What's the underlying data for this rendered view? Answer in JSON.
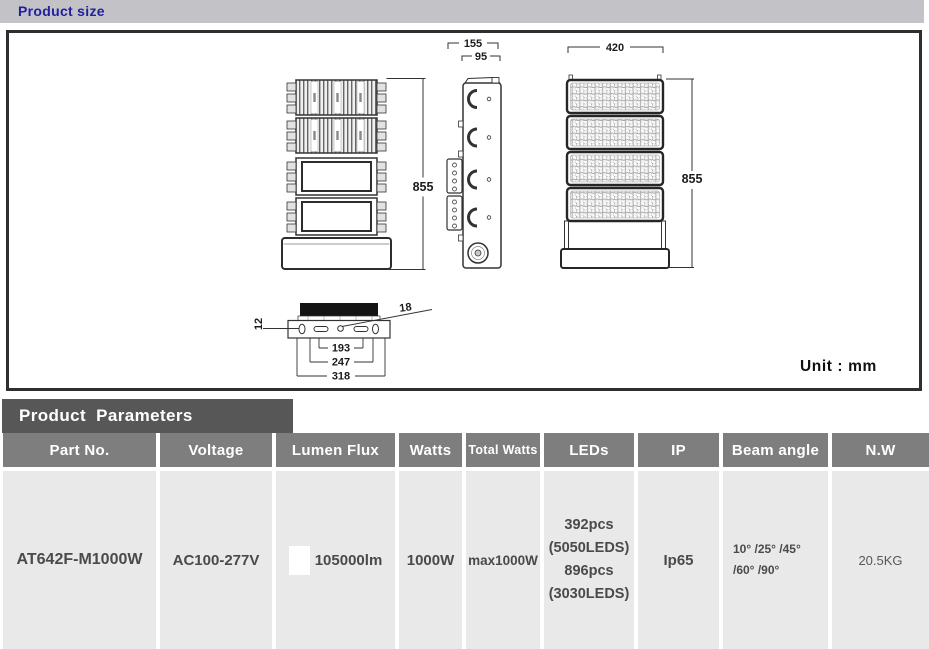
{
  "page": {
    "size_section_title": "Product size",
    "unit_label": "Unit : mm"
  },
  "drawing": {
    "dims": {
      "side_depth": "155",
      "side_body": "95",
      "front_width": "420",
      "back_height": "855",
      "front_height": "855",
      "mount_thickness": "12",
      "mount_hole": "18",
      "mount_slot_span": "193",
      "mount_hole_span": "247",
      "mount_width": "318"
    }
  },
  "parameters": {
    "section_title": "Product  Parameters",
    "columns": [
      "Part No.",
      "Voltage",
      "Lumen Flux",
      "Watts",
      "Total Watts",
      "LEDs",
      "IP",
      "Beam angle",
      "N.W"
    ],
    "row": {
      "part_no": "AT642F-M1000W",
      "voltage": "AC100-277V",
      "lumen_flux": "105000lm",
      "watts": "1000W",
      "total_watts": "max1000W",
      "leds_lines": [
        "392pcs",
        "(5050LEDS)",
        "896pcs",
        "(3030LEDS)"
      ],
      "ip": "Ip65",
      "beam_angle_lines": [
        "10° /25° /45°",
        "/60° /90°"
      ],
      "net_weight": "20.5KG"
    }
  },
  "colors": {
    "topbar_bg": "#c2c2c7",
    "title_text": "#221f9e",
    "section_header_bg": "#575757",
    "table_header_bg": "#7e7e7e",
    "table_cell_bg": "#e9e9e9",
    "table_text": "#4a4a4a",
    "drawing_border": "#2f2f2f"
  }
}
